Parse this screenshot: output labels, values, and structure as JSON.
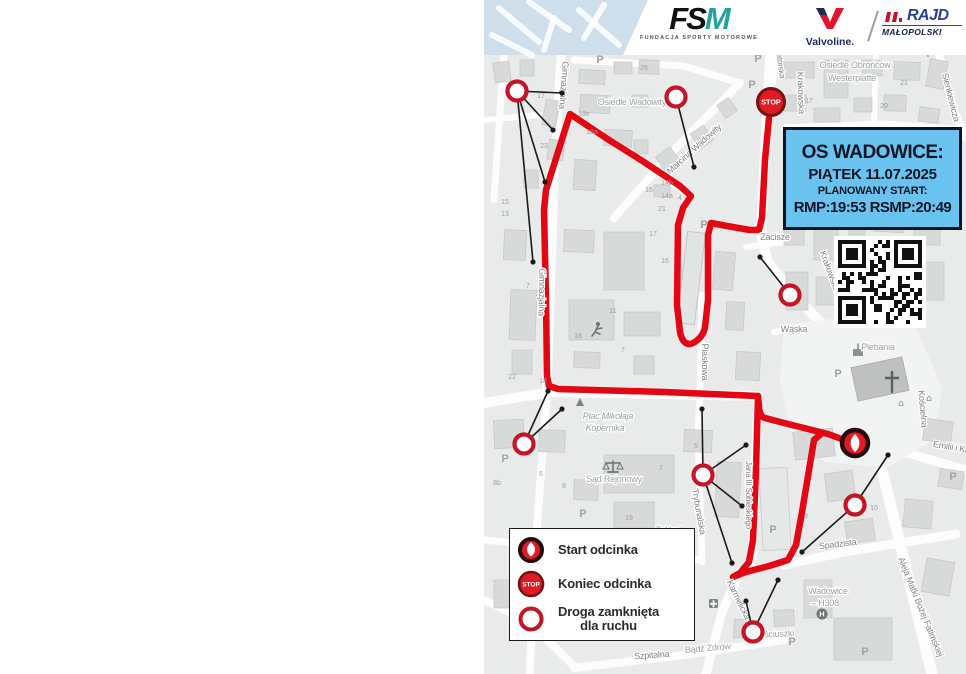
{
  "header": {
    "fsm": {
      "name_f": "FS",
      "name_m": "M",
      "subtitle": "FUNDACJA SPORTY MOTOROWE"
    },
    "valvoline": {
      "word": "Valvoline."
    },
    "rajd": {
      "line1": "RAJD",
      "line2": "MAŁOPOLSKI"
    }
  },
  "info_box": {
    "title": "OS WADOWICE:",
    "date": "PIĄTEK 11.07.2025",
    "start_label": "PLANOWANY START:",
    "times": "RMP:19:53 RSMP:20:49"
  },
  "legend": {
    "items": [
      {
        "icon": "start-marker",
        "label": "Start odcinka"
      },
      {
        "icon": "stop-marker",
        "label": "Koniec odcinka"
      },
      {
        "icon": "closed-road-marker",
        "label": "Droga zamknięta",
        "label2": "dla ruchu"
      }
    ]
  },
  "map": {
    "stop_marker_text": "STOP",
    "parking_glyph": "P",
    "street_labels": [
      {
        "t": "Gimnazjalna",
        "x": 77,
        "y": 85,
        "r": 94,
        "s": 9
      },
      {
        "t": "Gimnazjalna",
        "x": 55,
        "y": 292,
        "r": 91,
        "s": 9
      },
      {
        "t": "Marcina Wadowity",
        "x": 212,
        "y": 151,
        "r": -42,
        "s": 9
      },
      {
        "t": "Krakowska",
        "x": 314,
        "y": 93,
        "r": 88,
        "s": 9
      },
      {
        "t": "Zatorska",
        "x": 294,
        "y": 64,
        "r": 82,
        "s": 8
      },
      {
        "t": "Sienkiewicza",
        "x": 464,
        "y": 98,
        "r": 76,
        "s": 9
      },
      {
        "t": "Zacisze",
        "x": 291,
        "y": 240,
        "r": 0,
        "s": 9
      },
      {
        "t": "Krakowska",
        "x": 343,
        "y": 272,
        "r": 70,
        "s": 9
      },
      {
        "t": "Wąska",
        "x": 310,
        "y": 332,
        "r": 0,
        "s": 9
      },
      {
        "t": "Piaskowa",
        "x": 218,
        "y": 362,
        "r": 90,
        "s": 9
      },
      {
        "t": "Trybunalska",
        "x": 212,
        "y": 512,
        "r": 80,
        "s": 9
      },
      {
        "t": "Jana III Sobieskiego",
        "x": 262,
        "y": 495,
        "r": 90,
        "s": 8
      },
      {
        "t": "Karmelicka",
        "x": 252,
        "y": 601,
        "r": 64,
        "s": 9
      },
      {
        "t": "Spadzista",
        "x": 354,
        "y": 547,
        "r": -7,
        "s": 9
      },
      {
        "t": "Kościelna",
        "x": 436,
        "y": 409,
        "r": 85,
        "s": 9
      },
      {
        "t": "Emilii i Ka",
        "x": 467,
        "y": 450,
        "r": 10,
        "s": 9
      },
      {
        "t": "Aleja Matki Bożej Fatimskiej",
        "x": 434,
        "y": 608,
        "r": 68,
        "s": 9
      },
      {
        "t": "Szpitalna",
        "x": 168,
        "y": 658,
        "r": -4,
        "s": 9
      }
    ],
    "area_labels": [
      {
        "t": "Osiedle Wadowity",
        "x": 148,
        "y": 105
      },
      {
        "t": "Osiedle Obrońców",
        "x": 371,
        "y": 68
      },
      {
        "t": "Westerplatte",
        "x": 368,
        "y": 81
      },
      {
        "t": "Plebania",
        "x": 394,
        "y": 350
      },
      {
        "t": "Plac Mikołaja",
        "x": 124,
        "y": 419,
        "i": true
      },
      {
        "t": "Kopernika",
        "x": 121,
        "y": 431,
        "i": true
      },
      {
        "t": "Sąd Rejonowy",
        "x": 130,
        "y": 482
      },
      {
        "t": "Zakład",
        "x": 184,
        "y": 533
      },
      {
        "t": "Karny",
        "x": 182,
        "y": 544
      },
      {
        "t": "Wadowice",
        "x": 344,
        "y": 594
      },
      {
        "t": "– H308",
        "x": 341,
        "y": 606
      },
      {
        "t": "Bądź Zdrów",
        "x": 224,
        "y": 651,
        "r": -5
      },
      {
        "t": "Kościuszki",
        "x": 290,
        "y": 637,
        "r": -3
      }
    ],
    "house_numbers": [
      {
        "t": "26",
        "x": 160,
        "y": 70
      },
      {
        "t": "17",
        "x": 57,
        "y": 98
      },
      {
        "t": "18e",
        "x": 100,
        "y": 116
      },
      {
        "t": "18a",
        "x": 108,
        "y": 134
      },
      {
        "t": "23",
        "x": 60,
        "y": 148
      },
      {
        "t": "16",
        "x": 165,
        "y": 192
      },
      {
        "t": "14b",
        "x": 183,
        "y": 185
      },
      {
        "t": "14a",
        "x": 183,
        "y": 198
      },
      {
        "t": "4",
        "x": 196,
        "y": 200
      },
      {
        "t": "21",
        "x": 178,
        "y": 211
      },
      {
        "t": "17",
        "x": 169,
        "y": 236
      },
      {
        "t": "16",
        "x": 181,
        "y": 263
      },
      {
        "t": "11",
        "x": 129,
        "y": 313
      },
      {
        "t": "18",
        "x": 94,
        "y": 338
      },
      {
        "t": "7",
        "x": 139,
        "y": 352
      },
      {
        "t": "15",
        "x": 21,
        "y": 204
      },
      {
        "t": "13",
        "x": 21,
        "y": 216
      },
      {
        "t": "7",
        "x": 44,
        "y": 288
      },
      {
        "t": "22",
        "x": 28,
        "y": 379
      },
      {
        "t": "18",
        "x": 59,
        "y": 383
      },
      {
        "t": "8b",
        "x": 13,
        "y": 485
      },
      {
        "t": "6",
        "x": 57,
        "y": 476
      },
      {
        "t": "8",
        "x": 80,
        "y": 488
      },
      {
        "t": "7",
        "x": 177,
        "y": 470
      },
      {
        "t": "5",
        "x": 212,
        "y": 448
      },
      {
        "t": "19",
        "x": 145,
        "y": 520
      },
      {
        "t": "21",
        "x": 420,
        "y": 85
      },
      {
        "t": "20",
        "x": 400,
        "y": 108
      },
      {
        "t": "17",
        "x": 325,
        "y": 103
      },
      {
        "t": "12",
        "x": 436,
        "y": 146
      },
      {
        "t": "3",
        "x": 322,
        "y": 518
      },
      {
        "t": "10",
        "x": 390,
        "y": 510
      }
    ],
    "closed_road_markers": [
      {
        "x": 33,
        "y": 91
      },
      {
        "x": 192,
        "y": 97
      },
      {
        "x": 306,
        "y": 295
      },
      {
        "x": 40,
        "y": 444
      },
      {
        "x": 219,
        "y": 475
      },
      {
        "x": 371,
        "y": 505
      },
      {
        "x": 269,
        "y": 632
      }
    ],
    "pointer_lines": [
      {
        "x1": 33,
        "y1": 91,
        "x2": 78,
        "y2": 93
      },
      {
        "x1": 33,
        "y1": 91,
        "x2": 69,
        "y2": 130
      },
      {
        "x1": 33,
        "y1": 91,
        "x2": 61,
        "y2": 182
      },
      {
        "x1": 33,
        "y1": 91,
        "x2": 49,
        "y2": 262
      },
      {
        "x1": 192,
        "y1": 97,
        "x2": 210,
        "y2": 167
      },
      {
        "x1": 306,
        "y1": 295,
        "x2": 276,
        "y2": 257
      },
      {
        "x1": 40,
        "y1": 444,
        "x2": 64,
        "y2": 391
      },
      {
        "x1": 40,
        "y1": 444,
        "x2": 78,
        "y2": 409
      },
      {
        "x1": 219,
        "y1": 475,
        "x2": 218,
        "y2": 409
      },
      {
        "x1": 219,
        "y1": 475,
        "x2": 262,
        "y2": 445
      },
      {
        "x1": 219,
        "y1": 475,
        "x2": 258,
        "y2": 506
      },
      {
        "x1": 219,
        "y1": 475,
        "x2": 248,
        "y2": 563
      },
      {
        "x1": 371,
        "y1": 505,
        "x2": 404,
        "y2": 455
      },
      {
        "x1": 371,
        "y1": 505,
        "x2": 318,
        "y2": 552
      },
      {
        "x1": 269,
        "y1": 632,
        "x2": 294,
        "y2": 580
      },
      {
        "x1": 269,
        "y1": 632,
        "x2": 262,
        "y2": 601
      }
    ],
    "parking_labels": [
      {
        "x": 116,
        "y": 63
      },
      {
        "x": 274,
        "y": 62
      },
      {
        "x": 268,
        "y": 88
      },
      {
        "x": 220,
        "y": 228
      },
      {
        "x": 446,
        "y": 57
      },
      {
        "x": 21,
        "y": 462
      },
      {
        "x": 99,
        "y": 517
      },
      {
        "x": 289,
        "y": 533
      },
      {
        "x": 354,
        "y": 377
      },
      {
        "x": 308,
        "y": 645
      },
      {
        "x": 381,
        "y": 655
      },
      {
        "x": 469,
        "y": 480
      }
    ],
    "stop_marker": {
      "x": 287,
      "y": 102
    },
    "start_marker": {
      "x": 371,
      "y": 443
    },
    "helipad": {
      "x": 338,
      "y": 614
    }
  },
  "colors": {
    "route": "#e30613",
    "closed_ring": "#c41425",
    "marker_fill": "#e01b24",
    "stop_ring": "#731113",
    "start_ring": "#250b0b",
    "info_bg": "#69c3ee",
    "info_text": "#0d1524",
    "street_gray": "#7f8285",
    "area_gray": "#9aa0a3",
    "num_gray": "#9b9ea1",
    "rajd_blue": "#2d3f95",
    "rajd_red": "#c8102e",
    "fsm_teal": "#1fa39b"
  }
}
